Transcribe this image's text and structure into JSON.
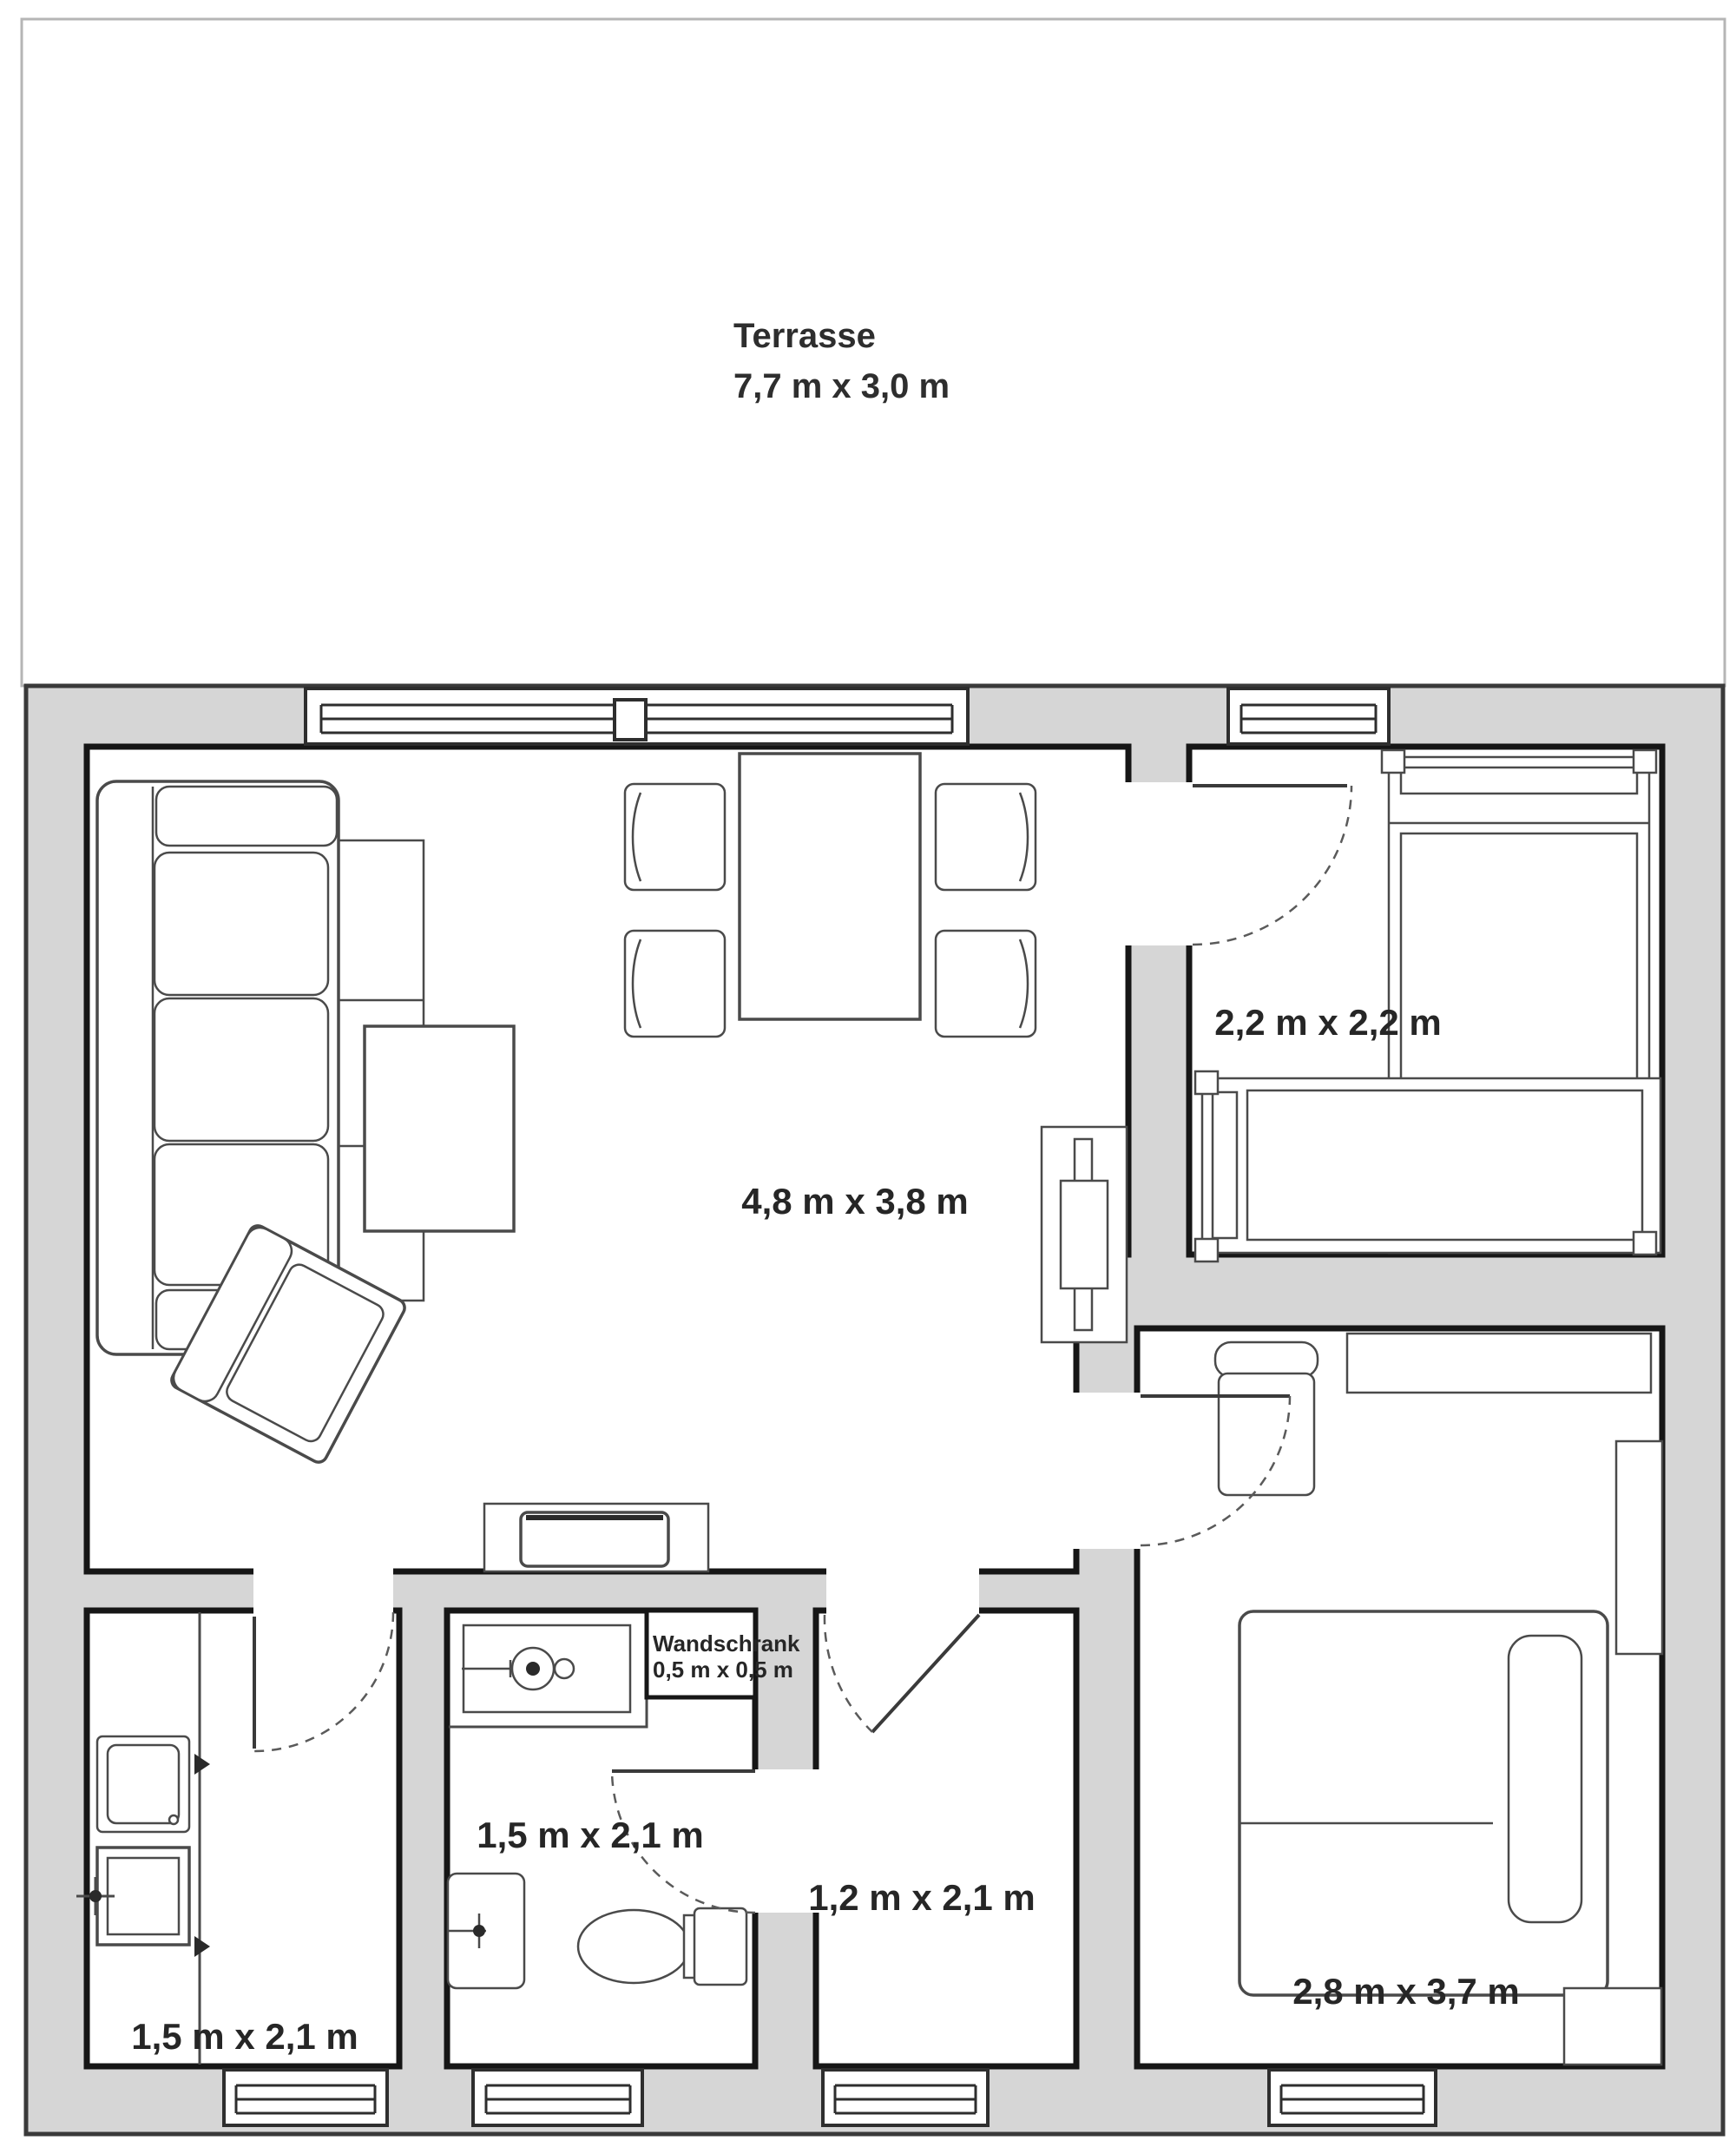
{
  "terrace": {
    "name": "Terrasse",
    "dimensions": "7,7 m x 3,0 m"
  },
  "rooms": {
    "living": {
      "name": "living-room",
      "dimensions": "4,8 m x 3,8 m"
    },
    "top_right": {
      "name": "small-room",
      "dimensions": "2,2 m x 2,2 m"
    },
    "bedroom": {
      "name": "bedroom",
      "dimensions": "2,8 m x 3,7 m"
    },
    "kitchen": {
      "name": "kitchen",
      "dimensions": "1,5 m x 2,1 m"
    },
    "bathroom": {
      "name": "bathroom",
      "dimensions": "1,5 m x 2,1 m"
    },
    "hallway": {
      "name": "hallway",
      "dimensions": "1,2 m x 2,1 m"
    },
    "closet": {
      "name": "Wandschrank",
      "dimensions": "0,5 m x 0,5 m"
    }
  },
  "colors": {
    "wall_fill": "#d6d6d6",
    "wall_stroke": "#3a3a3a",
    "room_outline": "#161616",
    "furniture_line": "#4a4a4a",
    "terrace_border": "#b5b5b5",
    "label_color": "#262626",
    "background": "#ffffff"
  }
}
